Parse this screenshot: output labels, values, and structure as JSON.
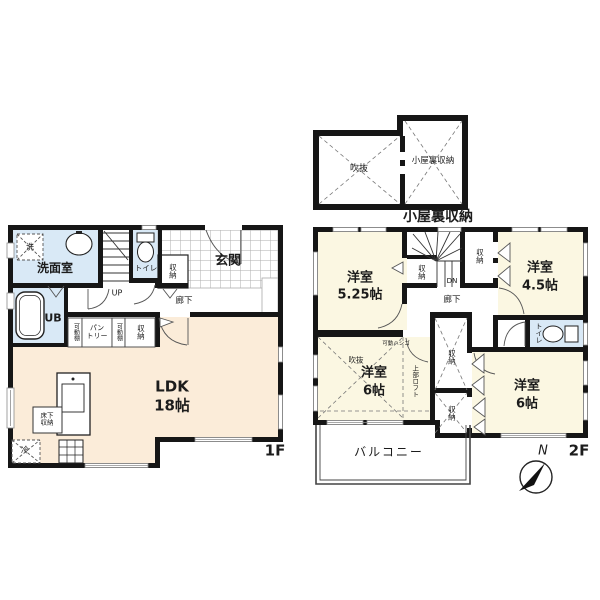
{
  "meta": {
    "plan_type": "floorplan",
    "colors": {
      "wall": "#161616",
      "ldk_cream": "#fbecd9",
      "room_yellow": "#fbf7e2",
      "wet_blue": "#d9e9f6",
      "line": "#555555",
      "tile_line": "#adadad"
    }
  },
  "floor1": {
    "floor_label": "1F",
    "washroom": "洗面室",
    "washer": "洗",
    "unit_bath": "UB",
    "toilet": "トイレ",
    "stairs_up": "UP",
    "closet_hall": "収納",
    "entrance": "玄関",
    "corridor": "廊下",
    "shelf_left": "可動棚",
    "pantry": [
      "パン",
      "トリー"
    ],
    "shelf_right": "可動棚",
    "closet_kitchen": "収納",
    "ldk_name": "LDK",
    "ldk_size": "18帖",
    "underfloor": [
      "床下",
      "収納"
    ],
    "fridge": "冷"
  },
  "attic": {
    "void": "吹抜",
    "storage_room": "小屋裏収納",
    "caption": "小屋裏収納"
  },
  "floor2": {
    "floor_label": "2F",
    "room_525_name": "洋室",
    "room_525_size": "5.25帖",
    "room_45_name": "洋室",
    "room_45_size": "4.5帖",
    "room_6l_name": "洋室",
    "room_6l_size": "6帖",
    "room_6r_name": "洋室",
    "room_6r_size": "6帖",
    "stairs_down": "DN",
    "corridor": "廊下",
    "toilet": "トイレ",
    "closet_stairs": "収納",
    "closet_north": "収納",
    "closet_mid": "収納",
    "closet_south": "収納",
    "void": "吹抜",
    "loft": "上部ロフト",
    "ladder": "可動ハシゴ",
    "balcony": "バルコニー",
    "compass_north": "N"
  }
}
